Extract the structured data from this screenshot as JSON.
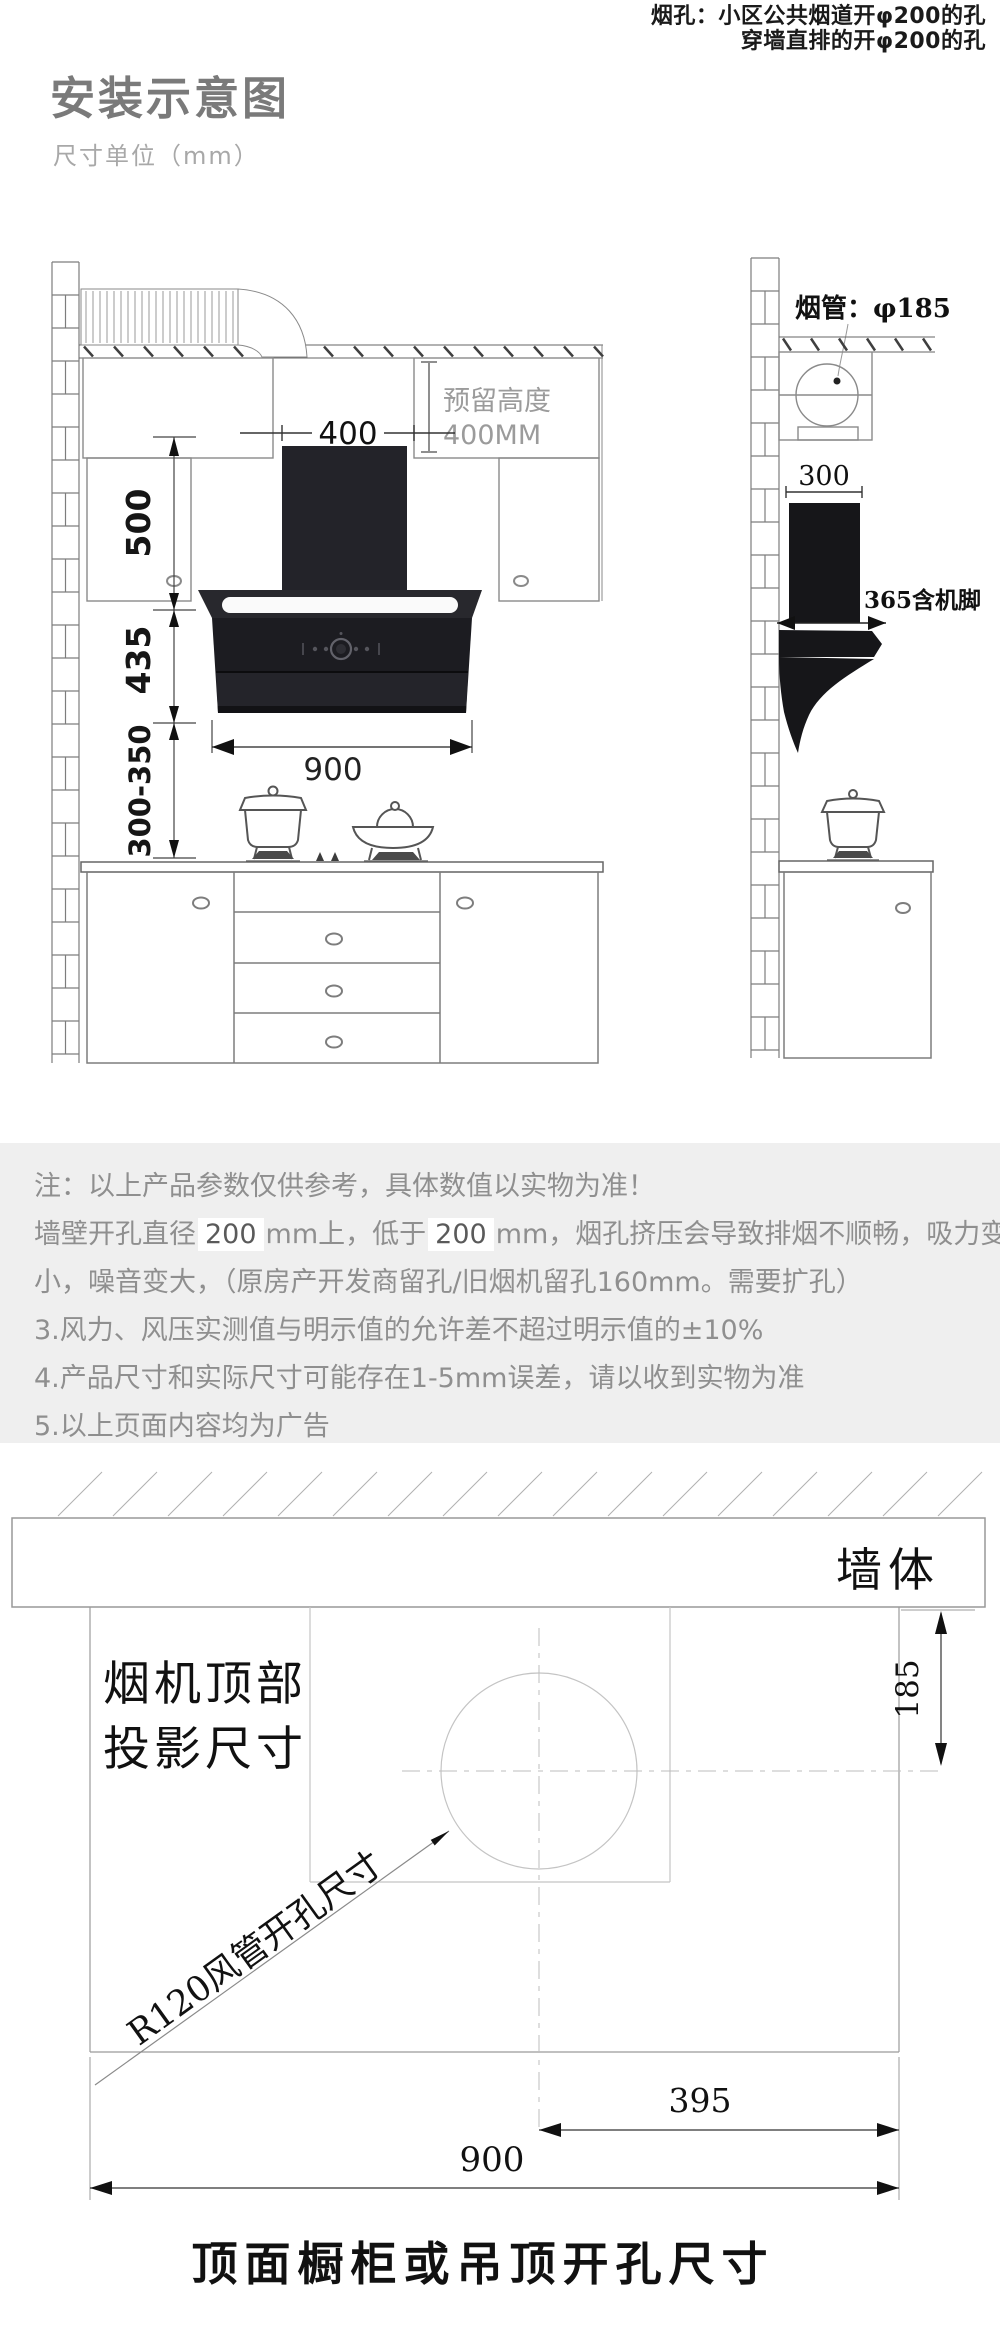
{
  "colors": {
    "note_bg": "#efefef",
    "title_gray": "#7a7a7a",
    "hood_black": "#1c1c21",
    "dim_line": "#333333"
  },
  "header": {
    "title": "安装示意图",
    "subtitle": "尺寸单位（mm）",
    "vent_note_line1": "烟孔：小区公共烟道开φ200的孔",
    "vent_note_line2": "穿墙直排的开φ200的孔"
  },
  "front_view": {
    "chimney_width": "400",
    "reserved_label": "预留高度",
    "reserved_value": "400MM",
    "dim_upper": "500",
    "dim_body": "435",
    "dim_clearance": "300-350",
    "hood_width": "900"
  },
  "side_view": {
    "pipe_label": "烟管：φ185",
    "depth_top": "300",
    "depth_body": "365含机脚"
  },
  "notes": {
    "line1": "注：以上产品参数仅供参考，具体数值以实物为准！",
    "line2_pre": "墙壁开孔直径",
    "line2_num1": "200",
    "line2_mid": "mm上，低于",
    "line2_num2": "200",
    "line2_tail": "mm，烟孔挤压会导致排烟不顺畅，吸力变",
    "line3": "小，噪音变大，（原房产开发商留孔/旧烟机留孔160mm。需要扩孔）",
    "line4": "3.风力、风压实测值与明示值的允许差不超过明示值的±10%",
    "line5": "4.产品尺寸和实际尺寸可能存在1-5mm误差，请以收到实物为准",
    "line6": "5.以上页面内容均为广告"
  },
  "projection": {
    "wall_label": "墙体",
    "title_line1": "烟机顶部",
    "title_line2": "投影尺寸",
    "dim_wall_offset": "185",
    "leader_label": "R120风管开孔尺寸",
    "dim_center_right": "395",
    "dim_full_width": "900",
    "caption": "顶面橱柜或吊顶开孔尺寸"
  }
}
